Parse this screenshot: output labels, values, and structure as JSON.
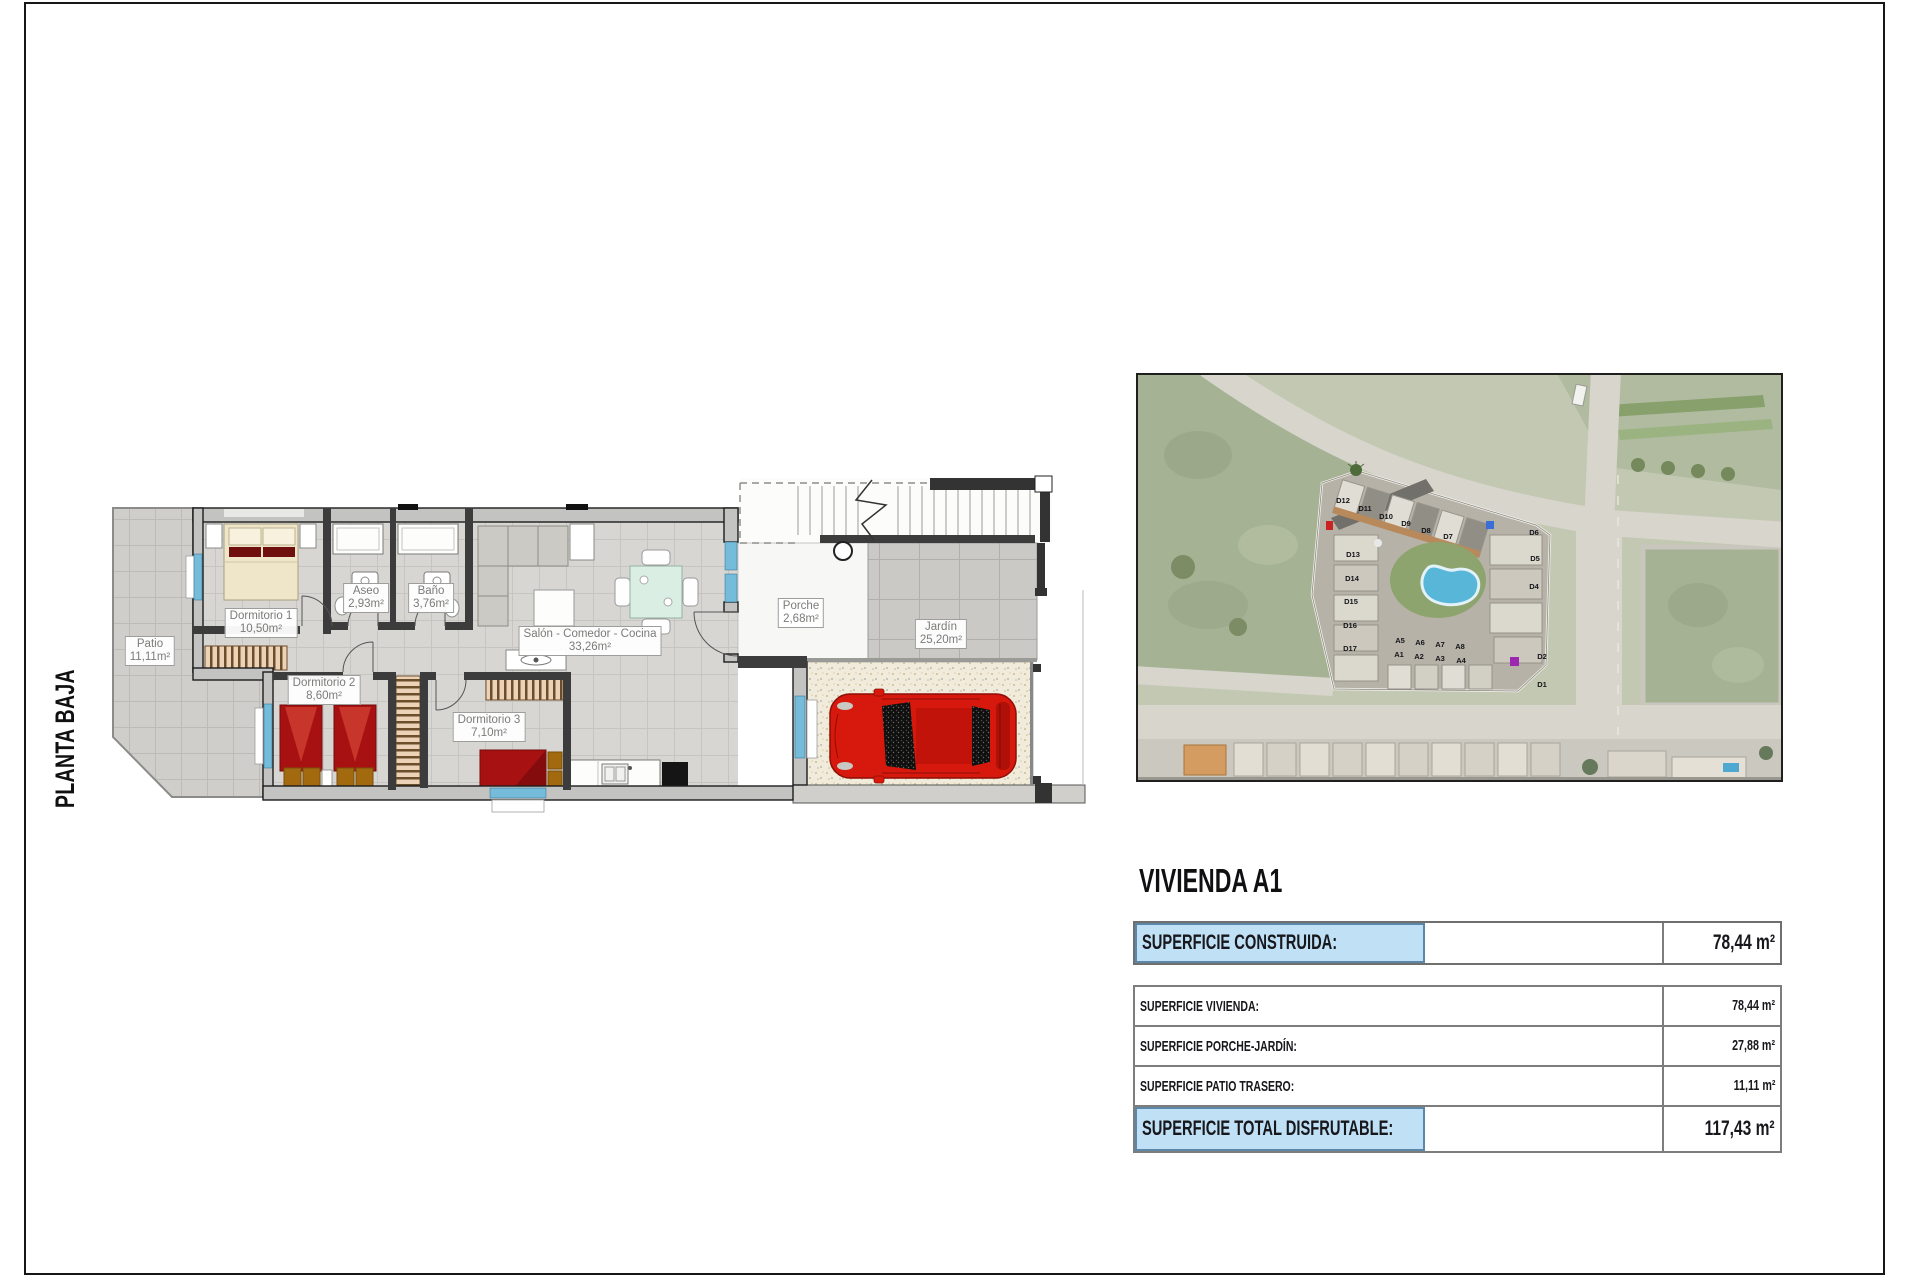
{
  "sheet": {
    "floor_label": "PLANTA BAJA"
  },
  "floor_plan": {
    "rooms": [
      {
        "id": "dormitorio-1",
        "name": "Dormitorio 1",
        "area": "10,50m²",
        "cx": 261,
        "cy": 623
      },
      {
        "id": "aseo",
        "name": "Aseo",
        "area": "2,93m²",
        "cx": 366,
        "cy": 598
      },
      {
        "id": "bano",
        "name": "Baño",
        "area": "3,76m²",
        "cx": 431,
        "cy": 598
      },
      {
        "id": "salon-comedor-cocina",
        "name": "Salón - Comedor - Cocina",
        "area": "33,26m²",
        "cx": 590,
        "cy": 641
      },
      {
        "id": "porche",
        "name": "Porche",
        "area": "2,68m²",
        "cx": 801,
        "cy": 613
      },
      {
        "id": "jardin",
        "name": "Jardín",
        "area": "25,20m²",
        "cx": 941,
        "cy": 634
      },
      {
        "id": "patio",
        "name": "Patio",
        "area": "11,11m²",
        "cx": 150,
        "cy": 651
      },
      {
        "id": "dormitorio-2",
        "name": "Dormitorio 2",
        "area": "8,60m²",
        "cx": 324,
        "cy": 690
      },
      {
        "id": "dormitorio-3",
        "name": "Dormitorio 3",
        "area": "7,10m²",
        "cx": 489,
        "cy": 727
      }
    ]
  },
  "site_map": {
    "unit_labels": [
      {
        "t": "D12",
        "x": 205,
        "y": 128
      },
      {
        "t": "D11",
        "x": 227,
        "y": 136
      },
      {
        "t": "D10",
        "x": 248,
        "y": 144
      },
      {
        "t": "D9",
        "x": 268,
        "y": 151
      },
      {
        "t": "D8",
        "x": 288,
        "y": 158
      },
      {
        "t": "D7",
        "x": 310,
        "y": 164
      },
      {
        "t": "D13",
        "x": 215,
        "y": 182
      },
      {
        "t": "D14",
        "x": 214,
        "y": 206
      },
      {
        "t": "D15",
        "x": 213,
        "y": 229
      },
      {
        "t": "D16",
        "x": 212,
        "y": 253
      },
      {
        "t": "D17",
        "x": 212,
        "y": 276
      },
      {
        "t": "D6",
        "x": 396,
        "y": 160
      },
      {
        "t": "D5",
        "x": 397,
        "y": 186
      },
      {
        "t": "D4",
        "x": 396,
        "y": 214
      },
      {
        "t": "D2",
        "x": 404,
        "y": 284
      },
      {
        "t": "D1",
        "x": 404,
        "y": 312
      },
      {
        "t": "A5",
        "x": 262,
        "y": 268
      },
      {
        "t": "A6",
        "x": 282,
        "y": 270
      },
      {
        "t": "A7",
        "x": 302,
        "y": 272
      },
      {
        "t": "A8",
        "x": 322,
        "y": 274
      },
      {
        "t": "A1",
        "x": 261,
        "y": 282
      },
      {
        "t": "A2",
        "x": 281,
        "y": 284
      },
      {
        "t": "A3",
        "x": 302,
        "y": 286
      },
      {
        "t": "A4",
        "x": 323,
        "y": 288
      }
    ]
  },
  "summary": {
    "title": "VIVIENDA A1",
    "constructed": {
      "label": "SUPERFICIE CONSTRUIDA:",
      "value": "78,44 m²"
    },
    "detail_rows": [
      {
        "label": "SUPERFICIE VIVIENDA:",
        "value": "78,44 m²"
      },
      {
        "label": "SUPERFICIE PORCHE-JARDÍN:",
        "value": "27,88 m²"
      },
      {
        "label": "SUPERFICIE PATIO TRASERO:",
        "value": "11,11 m²"
      }
    ],
    "total": {
      "label": "SUPERFICIE TOTAL DISFRUTABLE:",
      "value": "117,43 m²"
    }
  },
  "colors": {
    "highlight_fill": "#bfe0f5",
    "highlight_border": "#5d87a8",
    "wall": "#3c3c3c",
    "window_blue": "#74bcd9",
    "pool_blue": "#58b6d8",
    "car_red": "#d6180d"
  }
}
